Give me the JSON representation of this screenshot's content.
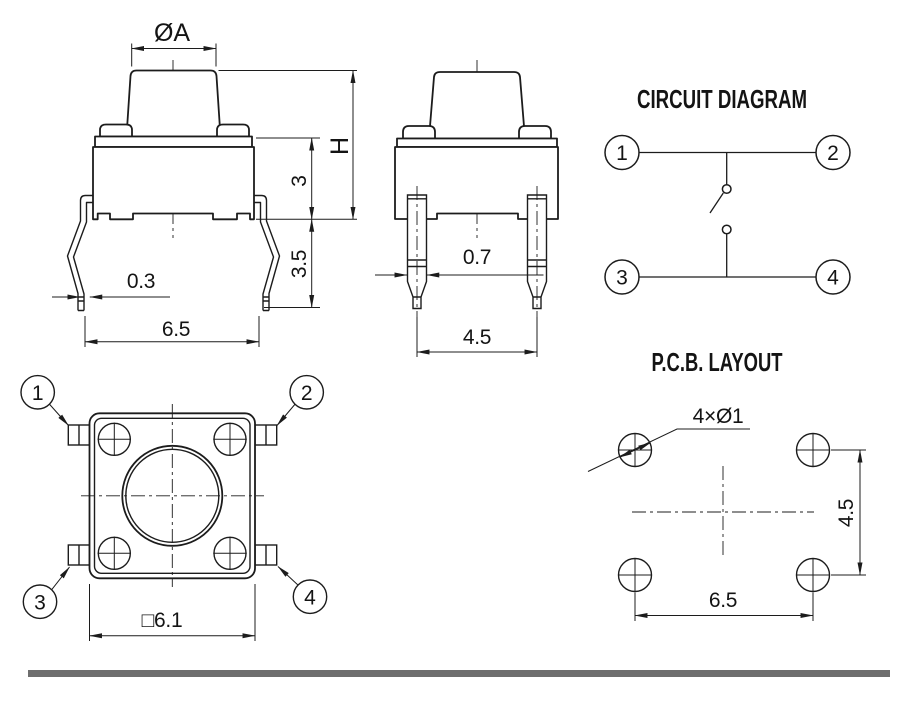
{
  "drawing": {
    "colors": {
      "line": "#1c1c1c",
      "divider_bar": "#6e6e6e",
      "background": "#ffffff"
    },
    "front_view": {
      "dim_cap_diameter": "ØA",
      "dim_total_height": "H",
      "dim_body_height": "3",
      "dim_leg_length": "3.5",
      "dim_leg_width": "0.3",
      "dim_leg_pitch": "6.5"
    },
    "side_view": {
      "dim_pin_width": "0.7",
      "dim_pin_pitch": "4.5"
    },
    "circuit_diagram": {
      "title": "CIRCUIT DIAGRAM",
      "terminal_1": "1",
      "terminal_2": "2",
      "terminal_3": "3",
      "terminal_4": "4"
    },
    "top_view": {
      "dim_body_size": "□6.1",
      "pin_1": "1",
      "pin_2": "2",
      "pin_3": "3",
      "pin_4": "4"
    },
    "pcb_layout": {
      "title": "P.C.B. LAYOUT",
      "dim_holes": "4×Ø1",
      "dim_vertical_pitch": "4.5",
      "dim_horizontal_pitch": "6.5"
    }
  }
}
